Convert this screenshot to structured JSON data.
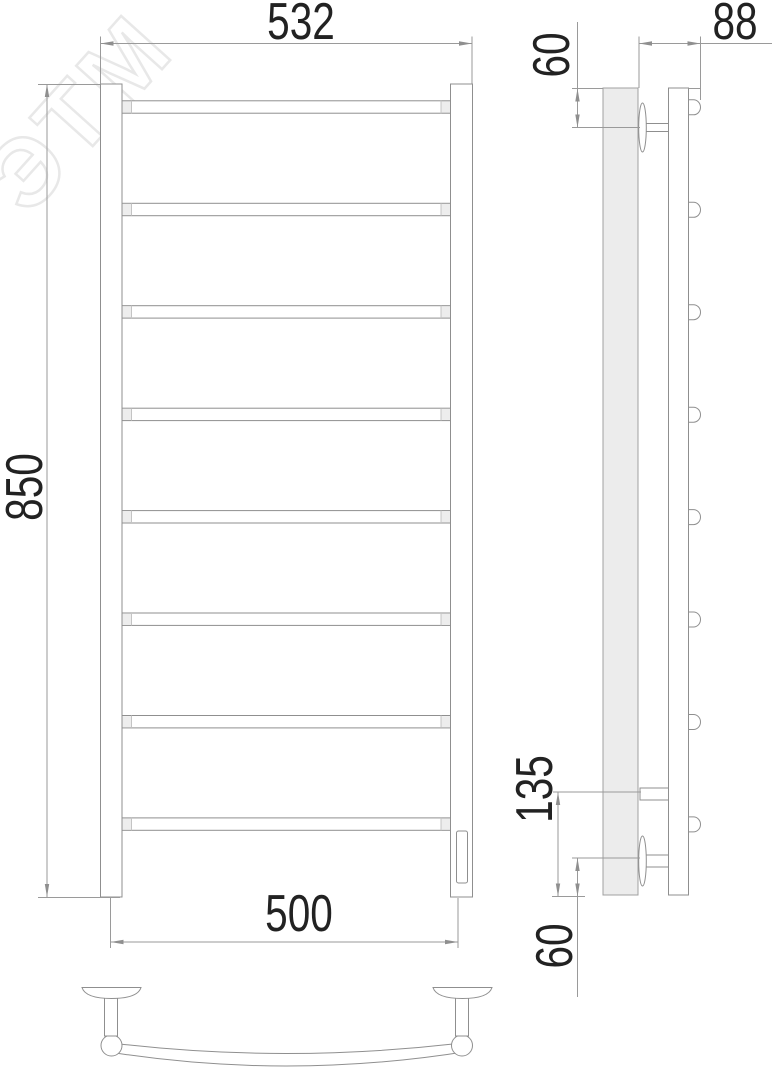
{
  "drawing": {
    "kind": "technical-drawing",
    "subject": "ladder towel rail (front, side and bottom views)",
    "rung_count": 8,
    "views": [
      "front",
      "side",
      "bottom"
    ]
  },
  "watermark": {
    "text": "ЭТМ"
  },
  "dimensions": {
    "overall_width": "532",
    "overall_height": "850",
    "mount_width": "500",
    "depth": "88",
    "top_offset": "60",
    "element_height": "135",
    "bottom_offset": "60"
  },
  "colors": {
    "object_line": "#8f8f8f",
    "dimension_line": "#9a9a9a",
    "dimension_text": "#222222",
    "wall_fill": "#ececec",
    "watermark": "#e8e8e8",
    "background": "#ffffff"
  }
}
